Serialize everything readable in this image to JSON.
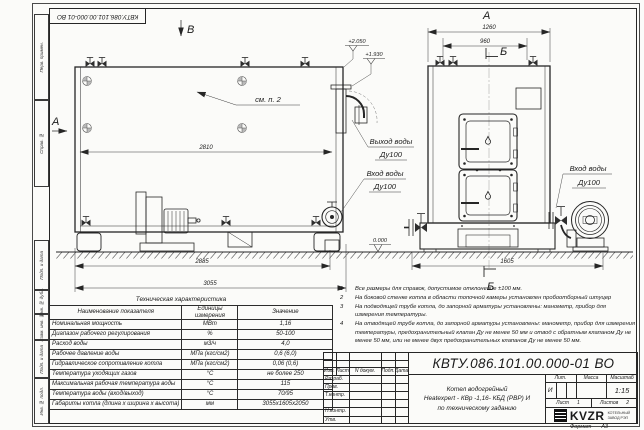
{
  "colors": {
    "ink": "#262626",
    "paper": "#fbfbf9"
  },
  "sheet": {
    "top_stamp": "КВТУ.086.101.00.000-01 ВО",
    "format_label": "Формат",
    "format_value": "А3",
    "margin_labels": [
      "Перв. примен.",
      "Справ. №",
      "Подп. и дата",
      "Инв. № дубл.",
      "Взам. инв. №",
      "Подп. и дата",
      "Инв. № подл."
    ]
  },
  "views": {
    "side": {
      "label_b": "В",
      "label_a": "А",
      "see_note": "см. п. 2",
      "dim_inner": "2810",
      "dim_skid": "2885",
      "dim_overall": "3055",
      "elev_top": "+2.050",
      "elev_outlet": "+1.930",
      "elev_zero": "0.000",
      "outlet_line1": "Выход воды",
      "outlet_line2": "Ду100",
      "inlet_line1": "Вход воды",
      "inlet_line2": "Ду100"
    },
    "front": {
      "label_a": "А",
      "label_b_top": "Б",
      "label_b_bottom": "Б",
      "dim_overall": "1260",
      "dim_valves": "960",
      "dim_base": "1605",
      "inlet_line1": "Вход воды",
      "inlet_line2": "Ду100"
    }
  },
  "tech_table": {
    "title": "Техническая характеристика",
    "headers": [
      "Наименование показателя",
      "Единицы измерения",
      "Значение"
    ],
    "rows": [
      {
        "name": "Номинальная мощность",
        "unit": "МВт",
        "value": "1,16"
      },
      {
        "name": "Диапазон рабочего регулирования",
        "unit": "%",
        "value": "50-100"
      },
      {
        "name": "Расход воды",
        "unit": "м3/ч",
        "value": "4,0"
      },
      {
        "name": "Рабочее давление воды",
        "unit": "МПа (кгс/см2)",
        "value": "0,6 (6,0)"
      },
      {
        "name": "Гидравлическое сопротивление котла",
        "unit": "МПа (кгс/см2)",
        "value": "0,06 (0,6)"
      },
      {
        "name": "Температура уходящих газов",
        "unit": "°С",
        "value": "не более 250"
      },
      {
        "name": "Максимальная рабочая температура воды",
        "unit": "°С",
        "value": "115"
      },
      {
        "name": "Температура воды (вход/выход)",
        "unit": "°С",
        "value": "70/95"
      },
      {
        "name": "Габариты котла (длина х ширина х высота)",
        "unit": "мм",
        "value": "3055х1605х2050"
      }
    ]
  },
  "notes": [
    {
      "num": "1",
      "text": "Все размеры для справок, допустимое отклонение  ±100 мм."
    },
    {
      "num": "2",
      "text": "На боковой стенке котла в области топочной камеры установлен пробоотборный штуцер"
    },
    {
      "num": "3",
      "text": "На  подводящей трубе котла, до запорной арматуры установлены: манометр, прибор для измерения температуры."
    },
    {
      "num": "4",
      "text": "На отводящей трубе котла, до запорной арматуры установлены: манометр, прибор для измерения температуры, предохранительный клапан Ду не менее 50 мм и отвод с обратным клапаном Ду не менее 50 мм, или не менее двух предохранительных клапанов Ду не менее 50 мм."
    }
  ],
  "title_block": {
    "doc_number": "КВТУ.086.101.00.000-01  ВО",
    "name_line_1": "Котел водогрейный",
    "name_line_2": "Heatexpert - КВр -1,16- КБД (РВР) И",
    "name_line_3": "по техническому заданию",
    "col_izm": "Изм.",
    "col_list": "Лист",
    "col_doc": "N докум.",
    "col_podp": "Подп.",
    "col_data": "Дата",
    "row_razrab": "Разраб.",
    "row_prov": "Пров.",
    "row_tkontr": "Т.контр.",
    "row_nkontr": "Н.контр.",
    "row_utv": "Утв.",
    "lit_label": "Лит.",
    "mass_label": "Масса",
    "scale_label": "Масштаб",
    "scale_value": "1:15",
    "sheet_label": "Лист",
    "sheet_value": "1",
    "sheets_label": "Листов",
    "sheets_value": "2",
    "logo_text": "KVZR",
    "logo_sub_1": "КОТЕЛЬНЫЙ",
    "logo_sub_2": "ЗАВОД РЭП"
  }
}
